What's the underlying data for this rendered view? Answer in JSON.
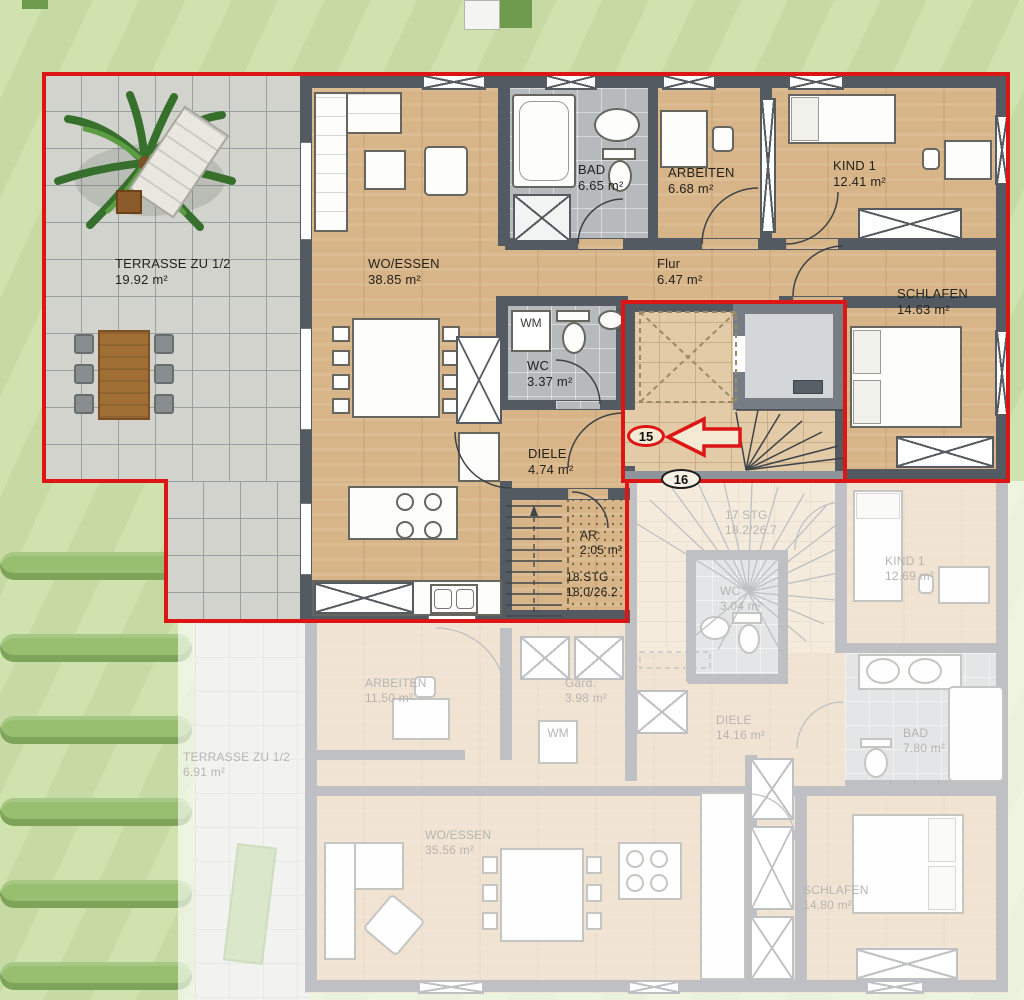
{
  "plan_type": "residential floor plan",
  "colors": {
    "highlight_red": "#dd1514",
    "wood_floor": "#d8b588",
    "tile_gray": "#b7babd",
    "lawn_green": "#cde1a9",
    "wall_gray": "#545a61"
  },
  "upper_floor": {
    "badge_unit": "15",
    "badge_unit_below": "16",
    "wm_label": "WM",
    "rooms": {
      "terrasse": {
        "name": "TERRASSE ZU 1/2",
        "area": "19.92 m²"
      },
      "woessen": {
        "name": "WO/ESSEN",
        "area": "38.85 m²"
      },
      "bad": {
        "name": "BAD",
        "area": "6.65 m²"
      },
      "arbeiten": {
        "name": "ARBEITEN",
        "area": "6.68 m²"
      },
      "kind1": {
        "name": "KIND 1",
        "area": "12.41 m²"
      },
      "flur": {
        "name": "Flur",
        "area": "6.47 m²"
      },
      "schlafen": {
        "name": "SCHLAFEN",
        "area": "14.63 m²"
      },
      "wc": {
        "name": "WC",
        "area": "3.37 m²"
      },
      "diele": {
        "name": "DIELE",
        "area": "4.74 m²"
      },
      "ar": {
        "name": "AR:",
        "area": "2.05 m²"
      }
    },
    "stairs": {
      "label": "18 STG",
      "ratio": "18.0/26.2"
    }
  },
  "lower_floor": {
    "wm_label": "WM",
    "rooms": {
      "terrasse": {
        "name": "TERRASSE ZU 1/2",
        "area": "6.91 m²"
      },
      "arbeiten": {
        "name": "ARBEITEN",
        "area": "11.50 m²"
      },
      "gard": {
        "name": "Gard.",
        "area": "3.98 m²"
      },
      "woessen": {
        "name": "WO/ESSEN",
        "area": "35.56 m²"
      },
      "diele": {
        "name": "DIELE",
        "area": "14.16 m²"
      },
      "wc": {
        "name": "WC",
        "area": "3.04 m²"
      },
      "kind1": {
        "name": "KIND 1",
        "area": "12.69 m²"
      },
      "bad": {
        "name": "BAD",
        "area": "7.80 m²"
      },
      "schlafen": {
        "name": "SCHLAFEN",
        "area": "14.80 m²"
      }
    },
    "stairs": {
      "label": "17 STG",
      "ratio": "18.2/26.7"
    }
  }
}
